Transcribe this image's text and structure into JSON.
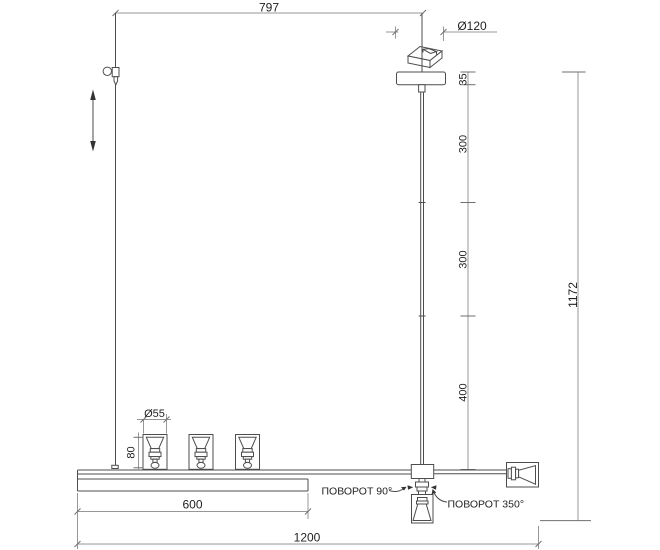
{
  "dimensions": {
    "top_offset": "797",
    "canopy_diameter": "Ø120",
    "canopy_height": "35",
    "rod_upper": "300",
    "rod_middle": "300",
    "rod_lower": "400",
    "total_height": "1172",
    "shade_diameter": "Ø55",
    "shade_height": "80",
    "track_length": "600",
    "total_length": "1200"
  },
  "annotations": {
    "rotation_90": "ПОВОРОТ 90°",
    "rotation_350": "ПОВОРОТ 350°"
  },
  "colors": {
    "object_line": "#4d4d4d",
    "dimension_line": "#979797",
    "text": "#1f1f1f",
    "background": "#ffffff"
  }
}
